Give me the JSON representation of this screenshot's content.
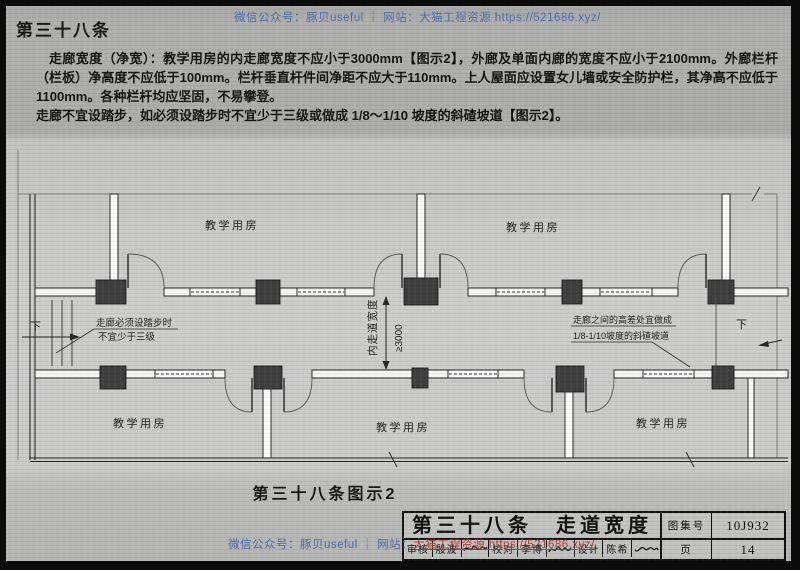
{
  "colors": {
    "watermark_blue": "#385ca8",
    "watermark_red": "#ad3126",
    "ink": "#161616",
    "column_fill": "#3e3e3e",
    "page_gray": "#ababaa",
    "drawing_gray": "#cccccb"
  },
  "header": {
    "article_no": "第三十八条",
    "watermark": "微信公众号：豚贝useful ｜ 网站：大猫工程资源 https://521686.xyz/"
  },
  "body": {
    "paragraph1": "走廊宽度（净宽）：教学用房的内走廊宽度不应小于3000mm【图示2】，外廊及单面内廊的宽度不应小于2100mm。外廊栏杆（栏板）净高度不应低于100mm。栏杆垂直杆件间净距不应大于110mm。上人屋面应设置女儿墙或安全防护栏，其净高不应低于1100mm。各种栏杆均应坚固，不易攀登。",
    "paragraph2": "走廊不宜设踏步，如必须设踏步时不宜少于三级或做成 1/8～1/10 坡度的斜碴坡道【图示2】。"
  },
  "plan": {
    "room_top_left": "教学用房",
    "room_top_right": "教学用房",
    "room_bottom_left": "教学用房",
    "room_bottom_center": "教学用房",
    "room_bottom_right": "教学用房",
    "dim_label": "内走道宽度",
    "dim_value": "≥3000",
    "down_left": "下",
    "down_right": "下",
    "note_left_1": "走廊必须设踏步时",
    "note_left_2": "不宜少于三级",
    "note_right_1": "走廊之间的高差处宜做成",
    "note_right_2": "1/8-1/10坡度的斜碴坡道",
    "caption": "第三十八条图示2"
  },
  "footer_watermark": {
    "blue": "微信公众号：豚贝useful ｜ 网站：",
    "red": "大猫工程资源 https://521686.xyz/"
  },
  "title_block": {
    "title": "第三十八条　走道宽度",
    "atlas_label": "图集号",
    "atlas_value": "10J932",
    "page_label": "页",
    "page_value": "14",
    "reviewer_label": "审核",
    "reviewer_name": "殷波",
    "checker_label": "校对",
    "checker_name": "李博",
    "designer_label": "设计",
    "designer_name": "陈希"
  }
}
